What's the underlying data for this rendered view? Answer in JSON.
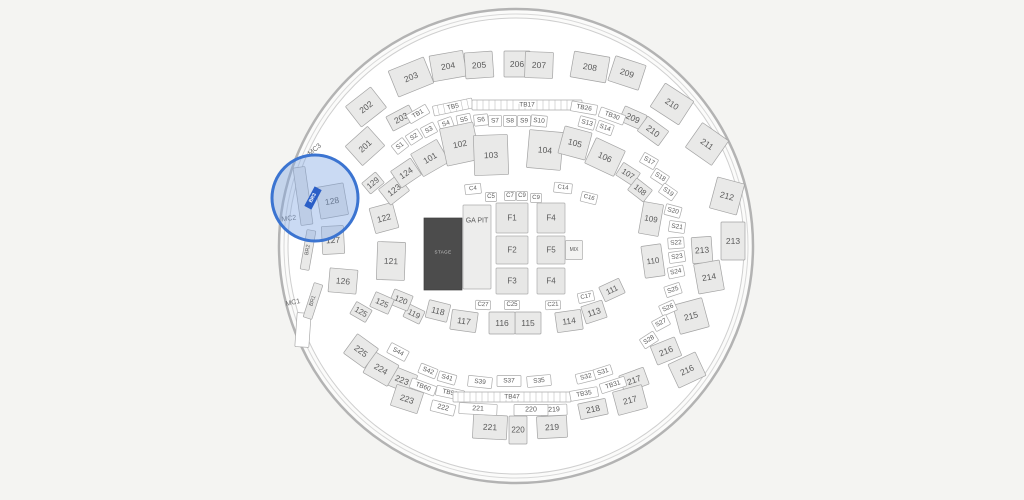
{
  "map": {
    "bg": "#f4f4f2",
    "arena": {
      "cx": 516,
      "cy": 246,
      "r_outer": 237,
      "r_mid": 232,
      "r_inner": 228,
      "wall_color": "#b3b3b3",
      "mid_color": "#d8d8d8",
      "inner_stroke": "#cfcfcf",
      "ring_fill": "#fbfbfa",
      "floor_fill": "#ffffff"
    },
    "palette": {
      "block_fill": "#e9e9e8",
      "block_stroke": "#a3a3a3",
      "white_fill": "#ffffff",
      "white_stroke": "#ababab",
      "floor_fill": "#e7e7e6",
      "floor_stroke": "#adadad",
      "ga_fill": "#ededec",
      "mix_fill": "#f3f3f2",
      "label_color": "#5a5a5a",
      "label_light": "#6b6b6b",
      "tick_color": "#b5b5b5"
    },
    "stage": {
      "label": "STAGE",
      "cx": 443,
      "cy": 254,
      "w": 38,
      "h": 72,
      "fill": "#4c4c4c",
      "stroke": "#3f3f3f",
      "text_color": "#c8c8c8"
    },
    "magnifier": {
      "cx": 315,
      "cy": 198,
      "r": 43,
      "fill": "rgba(128,168,226,0.42)",
      "stroke": "#3b74d1",
      "stroke_width": 3
    },
    "selected": {
      "label": "BR3",
      "x": 313,
      "y": 198,
      "w": 22,
      "h": 8,
      "r": -62,
      "fill": "#2b5fc7",
      "text_color": "#ffffff"
    },
    "sections": [
      {
        "t": "201",
        "x": 365,
        "y": 146,
        "w": 30,
        "h": 26,
        "r": -42
      },
      {
        "t": "202",
        "x": 366,
        "y": 107,
        "w": 32,
        "h": 26,
        "r": -38
      },
      {
        "t": "203",
        "x": 411,
        "y": 77,
        "w": 38,
        "h": 28,
        "r": -22
      },
      {
        "t": "203",
        "x": 401,
        "y": 118,
        "w": 26,
        "h": 16,
        "r": -28
      },
      {
        "t": "204",
        "x": 448,
        "y": 66,
        "w": 34,
        "h": 26,
        "r": -10
      },
      {
        "t": "205",
        "x": 479,
        "y": 65,
        "w": 28,
        "h": 26,
        "r": -4
      },
      {
        "t": "206",
        "x": 517,
        "y": 64,
        "w": 26,
        "h": 26,
        "r": 0
      },
      {
        "t": "207",
        "x": 539,
        "y": 65,
        "w": 28,
        "h": 26,
        "r": 2
      },
      {
        "t": "208",
        "x": 590,
        "y": 67,
        "w": 36,
        "h": 26,
        "r": 10
      },
      {
        "t": "209",
        "x": 627,
        "y": 73,
        "w": 32,
        "h": 26,
        "r": 18
      },
      {
        "t": "209",
        "x": 633,
        "y": 118,
        "w": 24,
        "h": 16,
        "r": 24
      },
      {
        "t": "210",
        "x": 672,
        "y": 104,
        "w": 34,
        "h": 28,
        "r": 33
      },
      {
        "t": "210",
        "x": 653,
        "y": 131,
        "w": 26,
        "h": 18,
        "r": 36
      },
      {
        "t": "211",
        "x": 707,
        "y": 144,
        "w": 32,
        "h": 30,
        "r": 35
      },
      {
        "t": "212",
        "x": 727,
        "y": 196,
        "w": 28,
        "h": 32,
        "r": 15
      },
      {
        "t": "213",
        "x": 733,
        "y": 241,
        "w": 24,
        "h": 38,
        "r": 0
      },
      {
        "t": "213",
        "x": 702,
        "y": 250,
        "w": 20,
        "h": 26,
        "r": -4
      },
      {
        "t": "214",
        "x": 709,
        "y": 277,
        "w": 26,
        "h": 30,
        "r": -10
      },
      {
        "t": "215",
        "x": 691,
        "y": 316,
        "w": 30,
        "h": 30,
        "r": -15
      },
      {
        "t": "216",
        "x": 666,
        "y": 351,
        "w": 26,
        "h": 20,
        "r": -22
      },
      {
        "t": "216",
        "x": 687,
        "y": 370,
        "w": 30,
        "h": 26,
        "r": -25
      },
      {
        "t": "217",
        "x": 634,
        "y": 380,
        "w": 26,
        "h": 18,
        "r": -20
      },
      {
        "t": "217",
        "x": 630,
        "y": 400,
        "w": 30,
        "h": 24,
        "r": -15
      },
      {
        "t": "218",
        "x": 593,
        "y": 409,
        "w": 28,
        "h": 16,
        "r": -12
      },
      {
        "t": "219",
        "x": 552,
        "y": 427,
        "w": 30,
        "h": 22,
        "r": -3
      },
      {
        "t": "220",
        "x": 518,
        "y": 430,
        "w": 18,
        "h": 28,
        "r": 0,
        "f": 8
      },
      {
        "t": "221",
        "x": 490,
        "y": 427,
        "w": 34,
        "h": 24,
        "r": 3
      },
      {
        "t": "219",
        "x": 554,
        "y": 410,
        "w": 26,
        "h": 11,
        "r": -2,
        "k": "w",
        "f": 7
      },
      {
        "t": "220",
        "x": 531,
        "y": 410,
        "w": 34,
        "h": 11,
        "r": 0,
        "k": "w",
        "f": 7
      },
      {
        "t": "221",
        "x": 478,
        "y": 409,
        "w": 38,
        "h": 11,
        "r": 3,
        "k": "w",
        "f": 7
      },
      {
        "t": "222",
        "x": 443,
        "y": 408,
        "w": 24,
        "h": 11,
        "r": 14,
        "k": "w",
        "f": 7
      },
      {
        "t": "223",
        "x": 402,
        "y": 380,
        "w": 26,
        "h": 20,
        "r": 22
      },
      {
        "t": "223",
        "x": 407,
        "y": 399,
        "w": 28,
        "h": 22,
        "r": 18
      },
      {
        "t": "224",
        "x": 381,
        "y": 369,
        "w": 28,
        "h": 24,
        "r": 30
      },
      {
        "t": "225",
        "x": 361,
        "y": 351,
        "w": 26,
        "h": 24,
        "r": 36
      },
      {
        "t": "S44",
        "x": 398,
        "y": 352,
        "w": 20,
        "h": 11,
        "r": 28,
        "k": "w"
      },
      {
        "t": "S42",
        "x": 428,
        "y": 371,
        "w": 18,
        "h": 10,
        "r": 22,
        "k": "w"
      },
      {
        "t": "S41",
        "x": 447,
        "y": 378,
        "w": 18,
        "h": 10,
        "r": 16,
        "k": "w"
      },
      {
        "t": "S39",
        "x": 480,
        "y": 382,
        "w": 24,
        "h": 11,
        "r": 6,
        "k": "w"
      },
      {
        "t": "S37",
        "x": 509,
        "y": 381,
        "w": 24,
        "h": 11,
        "r": 0,
        "k": "w"
      },
      {
        "t": "S35",
        "x": 539,
        "y": 381,
        "w": 24,
        "h": 11,
        "r": -5,
        "k": "w"
      },
      {
        "t": "S32",
        "x": 586,
        "y": 377,
        "w": 20,
        "h": 10,
        "r": -14,
        "k": "w"
      },
      {
        "t": "S31",
        "x": 603,
        "y": 372,
        "w": 18,
        "h": 10,
        "r": -18,
        "k": "w"
      },
      {
        "t": "TB60",
        "x": 423,
        "y": 387,
        "w": 26,
        "h": 10,
        "r": 20,
        "k": "w"
      },
      {
        "t": "TB56",
        "x": 450,
        "y": 393,
        "w": 28,
        "h": 10,
        "r": 12,
        "k": "w"
      },
      {
        "t": "TB47",
        "x": 512,
        "y": 397,
        "w": 118,
        "h": 10,
        "r": 0,
        "k": "s"
      },
      {
        "t": "TB35",
        "x": 584,
        "y": 394,
        "w": 28,
        "h": 10,
        "r": -10,
        "k": "w"
      },
      {
        "t": "TB31",
        "x": 613,
        "y": 385,
        "w": 26,
        "h": 10,
        "r": -18,
        "k": "w"
      },
      {
        "t": "TB1",
        "x": 418,
        "y": 114,
        "w": 22,
        "h": 10,
        "r": -30,
        "k": "w"
      },
      {
        "t": "TB5",
        "x": 453,
        "y": 107,
        "w": 40,
        "h": 10,
        "r": -12,
        "k": "s"
      },
      {
        "t": "TB17",
        "x": 527,
        "y": 105,
        "w": 110,
        "h": 10,
        "r": 0,
        "k": "s"
      },
      {
        "t": "TB26",
        "x": 584,
        "y": 108,
        "w": 26,
        "h": 10,
        "r": 10,
        "k": "w"
      },
      {
        "t": "TB30",
        "x": 612,
        "y": 116,
        "w": 26,
        "h": 10,
        "r": 20,
        "k": "w"
      },
      {
        "t": "S1",
        "x": 400,
        "y": 146,
        "w": 14,
        "h": 11,
        "r": -38,
        "k": "w"
      },
      {
        "t": "S2",
        "x": 414,
        "y": 137,
        "w": 14,
        "h": 11,
        "r": -33,
        "k": "w"
      },
      {
        "t": "S3",
        "x": 429,
        "y": 130,
        "w": 14,
        "h": 11,
        "r": -28,
        "k": "w"
      },
      {
        "t": "S4",
        "x": 446,
        "y": 124,
        "w": 14,
        "h": 11,
        "r": -20,
        "k": "w"
      },
      {
        "t": "S5",
        "x": 464,
        "y": 120,
        "w": 14,
        "h": 11,
        "r": -12,
        "k": "w"
      },
      {
        "t": "S6",
        "x": 481,
        "y": 120,
        "w": 14,
        "h": 11,
        "r": -6,
        "k": "w"
      },
      {
        "t": "S7",
        "x": 495,
        "y": 121,
        "w": 13,
        "h": 11,
        "r": -2,
        "k": "w"
      },
      {
        "t": "S8",
        "x": 510,
        "y": 121,
        "w": 13,
        "h": 11,
        "r": 0,
        "k": "w"
      },
      {
        "t": "S9",
        "x": 524,
        "y": 121,
        "w": 13,
        "h": 11,
        "r": 2,
        "k": "w"
      },
      {
        "t": "S10",
        "x": 539,
        "y": 121,
        "w": 16,
        "h": 11,
        "r": 5,
        "k": "w"
      },
      {
        "t": "S13",
        "x": 587,
        "y": 123,
        "w": 16,
        "h": 11,
        "r": 15,
        "k": "w"
      },
      {
        "t": "S14",
        "x": 605,
        "y": 128,
        "w": 16,
        "h": 11,
        "r": 20,
        "k": "w"
      },
      {
        "t": "S17",
        "x": 649,
        "y": 161,
        "w": 16,
        "h": 11,
        "r": 30,
        "k": "w"
      },
      {
        "t": "S18",
        "x": 660,
        "y": 177,
        "w": 16,
        "h": 11,
        "r": 33,
        "k": "w"
      },
      {
        "t": "S19",
        "x": 668,
        "y": 192,
        "w": 16,
        "h": 11,
        "r": 35,
        "k": "w"
      },
      {
        "t": "S20",
        "x": 673,
        "y": 211,
        "w": 16,
        "h": 11,
        "r": 15,
        "k": "w"
      },
      {
        "t": "S21",
        "x": 677,
        "y": 227,
        "w": 16,
        "h": 11,
        "r": 8,
        "k": "w"
      },
      {
        "t": "S22",
        "x": 676,
        "y": 243,
        "w": 16,
        "h": 11,
        "r": -4,
        "k": "w"
      },
      {
        "t": "S23",
        "x": 677,
        "y": 257,
        "w": 16,
        "h": 11,
        "r": -8,
        "k": "w"
      },
      {
        "t": "S24",
        "x": 676,
        "y": 272,
        "w": 16,
        "h": 11,
        "r": -12,
        "k": "w"
      },
      {
        "t": "S25",
        "x": 673,
        "y": 290,
        "w": 16,
        "h": 11,
        "r": -18,
        "k": "w"
      },
      {
        "t": "S26",
        "x": 668,
        "y": 308,
        "w": 16,
        "h": 11,
        "r": -24,
        "k": "w"
      },
      {
        "t": "S27",
        "x": 661,
        "y": 323,
        "w": 16,
        "h": 11,
        "r": -28,
        "k": "w"
      },
      {
        "t": "S28",
        "x": 649,
        "y": 340,
        "w": 16,
        "h": 11,
        "r": -33,
        "k": "w"
      },
      {
        "t": "101",
        "x": 430,
        "y": 158,
        "w": 30,
        "h": 26,
        "r": -30
      },
      {
        "t": "102",
        "x": 460,
        "y": 144,
        "w": 34,
        "h": 38,
        "r": -12
      },
      {
        "t": "103",
        "x": 491,
        "y": 155,
        "w": 34,
        "h": 40,
        "r": -2
      },
      {
        "t": "104",
        "x": 545,
        "y": 150,
        "w": 34,
        "h": 38,
        "r": 5
      },
      {
        "t": "105",
        "x": 575,
        "y": 143,
        "w": 28,
        "h": 28,
        "r": 15
      },
      {
        "t": "106",
        "x": 605,
        "y": 157,
        "w": 32,
        "h": 28,
        "r": 25
      },
      {
        "t": "107",
        "x": 628,
        "y": 174,
        "w": 20,
        "h": 15,
        "r": 33,
        "f": 8
      },
      {
        "t": "108",
        "x": 640,
        "y": 190,
        "w": 20,
        "h": 15,
        "r": 38,
        "f": 8
      },
      {
        "t": "109",
        "x": 651,
        "y": 219,
        "w": 20,
        "h": 32,
        "r": 10,
        "f": 8
      },
      {
        "t": "110",
        "x": 653,
        "y": 261,
        "w": 20,
        "h": 32,
        "r": -8,
        "f": 8
      },
      {
        "t": "111",
        "x": 612,
        "y": 290,
        "w": 22,
        "h": 16,
        "r": -25,
        "f": 8
      },
      {
        "t": "113",
        "x": 594,
        "y": 312,
        "w": 22,
        "h": 18,
        "r": -18
      },
      {
        "t": "114",
        "x": 569,
        "y": 321,
        "w": 26,
        "h": 20,
        "r": -8
      },
      {
        "t": "115",
        "x": 528,
        "y": 323,
        "w": 26,
        "h": 22,
        "r": 0
      },
      {
        "t": "116",
        "x": 502,
        "y": 323,
        "w": 26,
        "h": 22,
        "r": 0
      },
      {
        "t": "117",
        "x": 464,
        "y": 321,
        "w": 26,
        "h": 20,
        "r": 8
      },
      {
        "t": "118",
        "x": 438,
        "y": 311,
        "w": 22,
        "h": 18,
        "r": 14
      },
      {
        "t": "119",
        "x": 414,
        "y": 314,
        "w": 18,
        "h": 14,
        "r": 26,
        "f": 8
      },
      {
        "t": "120",
        "x": 401,
        "y": 300,
        "w": 20,
        "h": 16,
        "r": 22,
        "f": 8
      },
      {
        "t": "121",
        "x": 391,
        "y": 261,
        "w": 28,
        "h": 38,
        "r": 2
      },
      {
        "t": "122",
        "x": 384,
        "y": 218,
        "w": 24,
        "h": 26,
        "r": -15
      },
      {
        "t": "123",
        "x": 394,
        "y": 190,
        "w": 24,
        "h": 20,
        "r": -38
      },
      {
        "t": "124",
        "x": 406,
        "y": 173,
        "w": 24,
        "h": 20,
        "r": -34
      },
      {
        "t": "129",
        "x": 373,
        "y": 183,
        "w": 18,
        "h": 14,
        "r": -40,
        "f": 8
      },
      {
        "t": "125",
        "x": 382,
        "y": 303,
        "w": 20,
        "h": 16,
        "r": 24,
        "f": 8
      },
      {
        "t": "125",
        "x": 361,
        "y": 312,
        "w": 18,
        "h": 14,
        "r": 30,
        "f": 8
      },
      {
        "t": "126",
        "x": 343,
        "y": 281,
        "w": 28,
        "h": 24,
        "r": 5
      },
      {
        "t": "127",
        "x": 333,
        "y": 240,
        "w": 22,
        "h": 28,
        "r": -3
      },
      {
        "t": "",
        "x": 303,
        "y": 196,
        "w": 12,
        "h": 58,
        "r": -8
      },
      {
        "t": "",
        "x": 303,
        "y": 330,
        "w": 14,
        "h": 34,
        "r": 4,
        "k": "w"
      },
      {
        "t": "128",
        "x": 332,
        "y": 201,
        "w": 28,
        "h": 32,
        "r": -10
      },
      {
        "t": "C4",
        "x": 473,
        "y": 189,
        "w": 16,
        "h": 10,
        "r": -6,
        "k": "w",
        "f": 6
      },
      {
        "t": "C5",
        "x": 491,
        "y": 197,
        "w": 11,
        "h": 9,
        "r": 0,
        "k": "w",
        "f": 6
      },
      {
        "t": "C7",
        "x": 510,
        "y": 196,
        "w": 11,
        "h": 9,
        "r": 0,
        "k": "w",
        "f": 6
      },
      {
        "t": "C9",
        "x": 522,
        "y": 196,
        "w": 11,
        "h": 9,
        "r": 0,
        "k": "w",
        "f": 6
      },
      {
        "t": "C9",
        "x": 536,
        "y": 198,
        "w": 11,
        "h": 9,
        "r": 2,
        "k": "w",
        "f": 6
      },
      {
        "t": "C14",
        "x": 563,
        "y": 188,
        "w": 18,
        "h": 10,
        "r": 6,
        "k": "w",
        "f": 6
      },
      {
        "t": "C16",
        "x": 589,
        "y": 198,
        "w": 16,
        "h": 10,
        "r": 14,
        "k": "w",
        "f": 6
      },
      {
        "t": "C17",
        "x": 586,
        "y": 297,
        "w": 16,
        "h": 10,
        "r": -12,
        "k": "w",
        "f": 6
      },
      {
        "t": "C21",
        "x": 553,
        "y": 305,
        "w": 15,
        "h": 9,
        "r": -3,
        "k": "w",
        "f": 6
      },
      {
        "t": "C25",
        "x": 512,
        "y": 305,
        "w": 15,
        "h": 9,
        "r": 0,
        "k": "w",
        "f": 6
      },
      {
        "t": "C27",
        "x": 483,
        "y": 305,
        "w": 15,
        "h": 9,
        "r": 2,
        "k": "w",
        "f": 6
      },
      {
        "t": "GA PIT",
        "x": 477,
        "y": 247,
        "w": 28,
        "h": 84,
        "r": 0,
        "k": "g",
        "f": 7,
        "ly": -26
      },
      {
        "t": "F1",
        "x": 512,
        "y": 218,
        "w": 32,
        "h": 30,
        "r": 0,
        "k": "f"
      },
      {
        "t": "F2",
        "x": 512,
        "y": 250,
        "w": 32,
        "h": 28,
        "r": 0,
        "k": "f"
      },
      {
        "t": "F3",
        "x": 512,
        "y": 281,
        "w": 32,
        "h": 26,
        "r": 0,
        "k": "f"
      },
      {
        "t": "F4",
        "x": 551,
        "y": 218,
        "w": 28,
        "h": 30,
        "r": 0,
        "k": "f"
      },
      {
        "t": "F5",
        "x": 551,
        "y": 250,
        "w": 28,
        "h": 28,
        "r": 0,
        "k": "f"
      },
      {
        "t": "F4",
        "x": 551,
        "y": 281,
        "w": 28,
        "h": 26,
        "r": 0,
        "k": "f"
      },
      {
        "t": "MIX",
        "x": 574,
        "y": 250,
        "w": 17,
        "h": 19,
        "r": 0,
        "k": "m",
        "f": 5
      },
      {
        "t": "MC3",
        "x": 315,
        "y": 150,
        "w": 0,
        "h": 0,
        "r": -40,
        "k": "l",
        "f": 7
      },
      {
        "t": "MC2",
        "x": 289,
        "y": 219,
        "w": 0,
        "h": 0,
        "r": -8,
        "k": "l",
        "f": 7
      },
      {
        "t": "MC1",
        "x": 293,
        "y": 303,
        "w": 0,
        "h": 0,
        "r": -12,
        "k": "l",
        "f": 7
      },
      {
        "t": "BR2",
        "x": 308,
        "y": 250,
        "w": 40,
        "h": 9,
        "r": -80,
        "f": 5.5
      },
      {
        "t": "BR1",
        "x": 313,
        "y": 301,
        "w": 36,
        "h": 9,
        "r": -72,
        "f": 5.5
      }
    ]
  }
}
